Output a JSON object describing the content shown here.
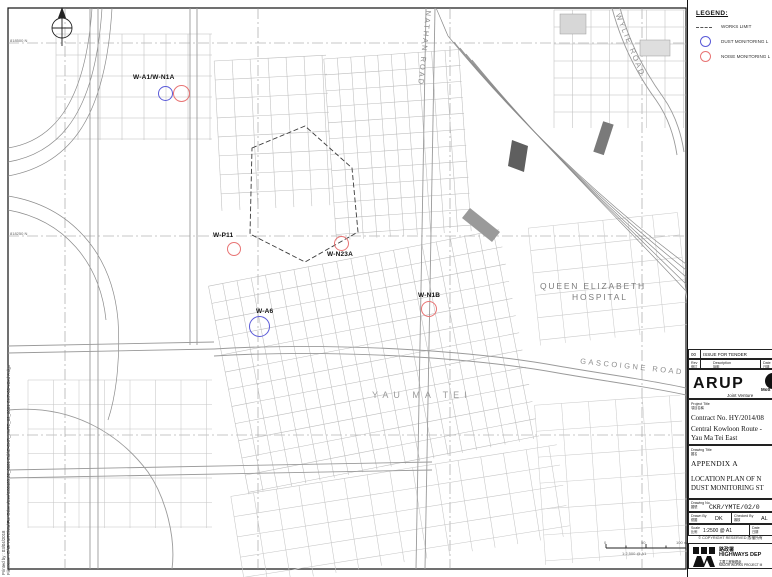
{
  "legend": {
    "title": "LEGEND:",
    "works_limit": "WORKS LIMIT",
    "dust": "DUST MONITORING L",
    "noise": "NOISE MONITORING L"
  },
  "map": {
    "grid_label_top": "818500 N",
    "grid_label_mid": "818250 N",
    "hospital_line1": "QUEEN ELIZABETH",
    "hospital_line2": "HOSPITAL",
    "district": "YAU MA TEI",
    "road_nathan": "NATHAN ROAD",
    "road_wylie": "WYLIE ROAD",
    "road_gascoigne": "GASCOIGNE ROAD",
    "stations": [
      {
        "id": "W-A1/W-N1A",
        "type": "dust-and-noise"
      },
      {
        "id": "W-P11",
        "type": "noise"
      },
      {
        "id": "W-N23A",
        "type": "noise"
      },
      {
        "id": "W-N1B",
        "type": "noise"
      },
      {
        "id": "W-A6",
        "type": "dust"
      }
    ],
    "scalebar": {
      "zero": "0",
      "fifty": "50",
      "hundred": "100 m",
      "caption": "1:2,500 @ A1"
    }
  },
  "colors": {
    "dust_marker": "#5a5ad8",
    "noise_marker": "#e87474",
    "linework": "#9a9a9a"
  },
  "titleblock": {
    "revision": {
      "no": "00",
      "description": "ISSUE FOR TENDER",
      "col_rev": "Rev",
      "col_rev_cn": "修訂",
      "col_desc": "Description",
      "col_desc_cn": "說明",
      "col_date": "Date",
      "col_date_cn": "日期"
    },
    "firm": {
      "name": "ARUP",
      "partner": "Mott",
      "jv": "Joint Venture"
    },
    "project": {
      "label": "Project Title",
      "label_cn": "項目名稱",
      "contract": "Contract No. HY/2014/08",
      "line1": "Central Kowloon Route -",
      "line2": "Yau Ma Tei East"
    },
    "drawing": {
      "label": "Drawing Title",
      "label_cn": "圖名",
      "appendix": "APPENDIX A",
      "line1": "LOCATION PLAN OF N",
      "line2": "DUST MONITORING ST"
    },
    "fields": {
      "no_label": "Drawing No.",
      "no_label_cn": "圖號",
      "no_value": "CKR/YMTE/02/0",
      "drawn_label": "Drawn By",
      "drawn_cn": "繪圖",
      "drawn": "DK",
      "checked_label": "Checked By",
      "checked_cn": "審核",
      "checked": "AL",
      "scale_label": "Scale",
      "scale_cn": "比例",
      "scale": "1:2500 @ A1",
      "date_label": "Date",
      "date_cn": "日期"
    },
    "copyright": "© COPYRIGHT RESERVED 版權所有",
    "department": {
      "cn": "路政署",
      "en": "HIGHWAYS DEP",
      "unit_cn": "主要工程管理處",
      "unit_en": "MAJOR WORKS PROJECT M"
    }
  },
  "plot": {
    "printed_label": "Printed by :",
    "printed_value": "03/04/2018",
    "filename_label": "Filename :",
    "filename_value": "E:\\G YMTE\\Wa\\For Others\\Lee\\180403 02_0001 Edit\\E-CKR_YMTE_02_0001 CKR-00-e0ed A.dgn"
  }
}
